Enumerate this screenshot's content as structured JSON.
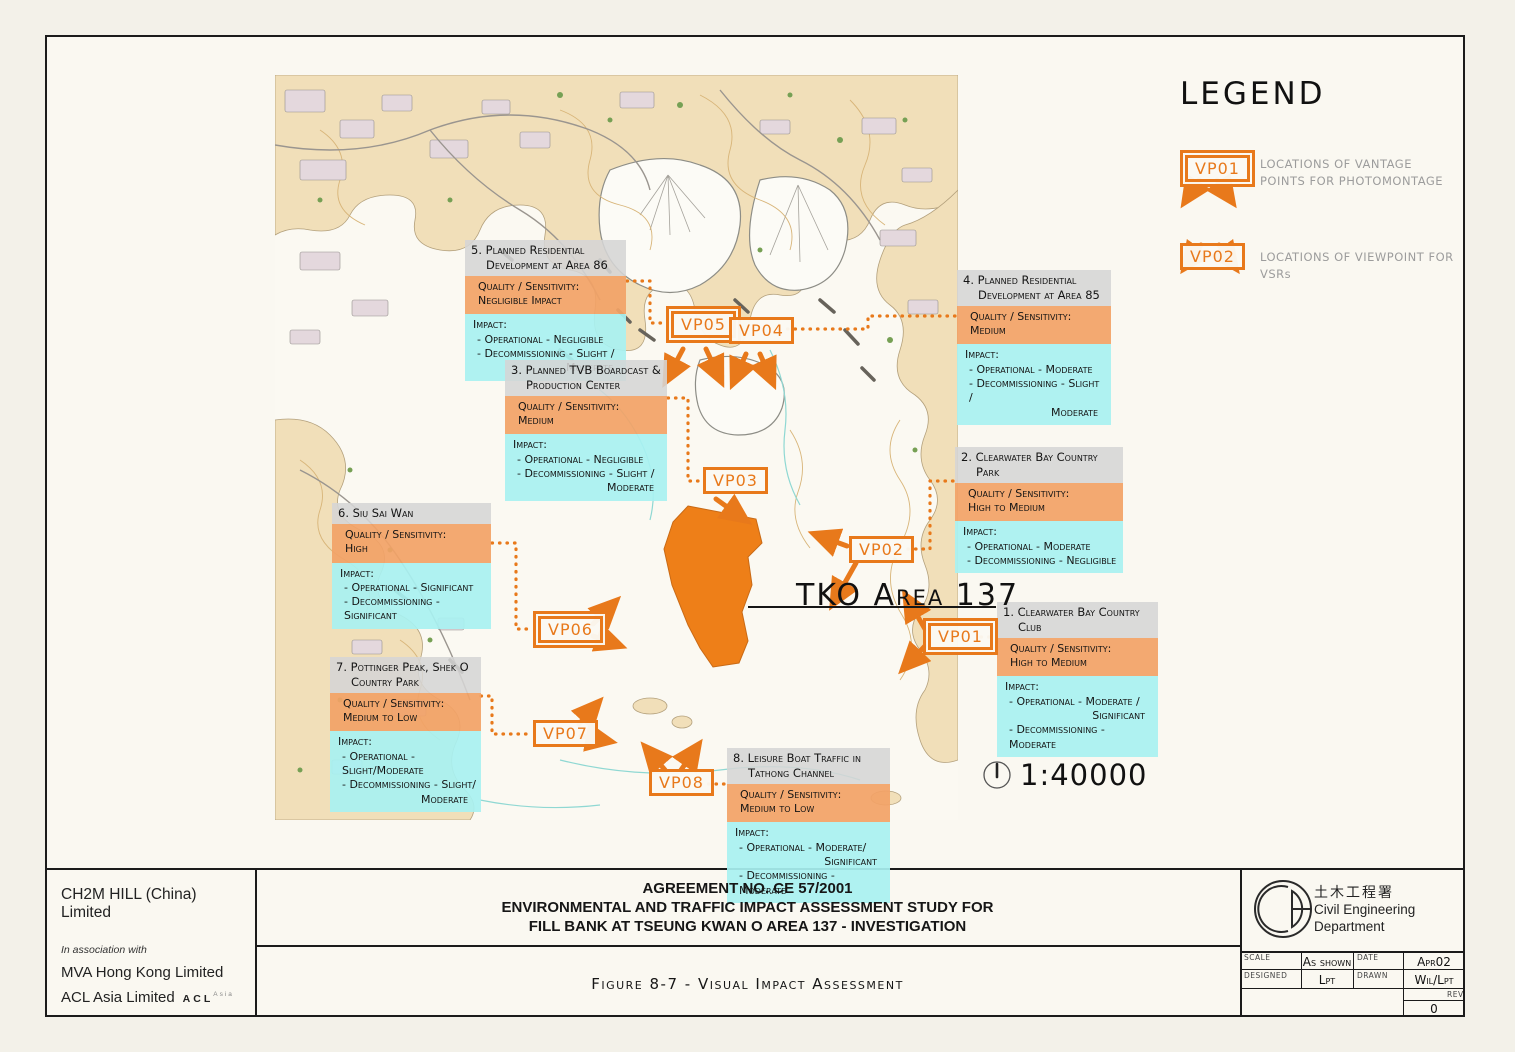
{
  "legend": {
    "title": "LEGEND",
    "items": [
      {
        "marker": "VP01",
        "label": "LOCATIONS OF VANTAGE POINTS FOR PHOTOMONTAGE"
      },
      {
        "marker": "VP02",
        "label": "LOCATIONS OF VIEWPOINT FOR VSRs"
      }
    ]
  },
  "map": {
    "area_label": "TKO Area 137",
    "scale_text": "1:40000",
    "markers": [
      {
        "label": "VP01"
      },
      {
        "label": "VP02"
      },
      {
        "label": "VP03"
      },
      {
        "label": "VP04"
      },
      {
        "label": "VP05"
      },
      {
        "label": "VP06"
      },
      {
        "label": "VP07"
      },
      {
        "label": "VP08"
      }
    ]
  },
  "callouts": [
    {
      "title": "1. Clearwater Bay Country Club",
      "quality_label": "Quality / Sensitivity:",
      "quality_value": "High to Medium",
      "impact_label": "Impact:",
      "impact_lines": [
        "- Operational - Moderate /",
        "Significant",
        "- Decommissioning - Moderate"
      ]
    },
    {
      "title": "2. Clearwater Bay Country Park",
      "quality_label": "Quality / Sensitivity:",
      "quality_value": "High to Medium",
      "impact_label": "Impact:",
      "impact_lines": [
        "- Operational - Moderate",
        "- Decommissioning - Negligible"
      ]
    },
    {
      "title": "3. Planned TVB Boardcast & Production Center",
      "quality_label": "Quality / Sensitivity:",
      "quality_value": "Medium",
      "impact_label": "Impact:",
      "impact_lines": [
        "- Operational - Negligible",
        "- Decommissioning - Slight /",
        "Moderate"
      ]
    },
    {
      "title": "4. Planned Residential Development at Area 85",
      "quality_label": "Quality / Sensitivity:",
      "quality_value": "Medium",
      "impact_label": "Impact:",
      "impact_lines": [
        "- Operational - Moderate",
        "- Decommissioning - Slight /",
        "Moderate"
      ]
    },
    {
      "title": "5. Planned Residential Development at Area 86",
      "quality_label": "Quality / Sensitivity:",
      "quality_value": "Negligible Impact",
      "impact_label": "Impact:",
      "impact_lines": [
        "- Operational - Negligible",
        "- Decommissioning - Slight /",
        "Moderate"
      ]
    },
    {
      "title": "6. Siu Sai Wan",
      "quality_label": "Quality / Sensitivity:",
      "quality_value": "High",
      "impact_label": "Impact:",
      "impact_lines": [
        "- Operational - Significant",
        "- Decommissioning - Significant"
      ]
    },
    {
      "title": "7. Pottinger Peak, Shek O Country Park",
      "quality_label": "Quality / Sensitivity:",
      "quality_value": "Medium to Low",
      "impact_label": "Impact:",
      "impact_lines": [
        "- Operational - Slight/Moderate",
        "- Decommissioning - Slight/",
        "Moderate"
      ]
    },
    {
      "title": "8. Leisure Boat Traffic in Tathong Channel",
      "quality_label": "Quality / Sensitivity:",
      "quality_value": "Medium to Low",
      "impact_label": "Impact:",
      "impact_lines": [
        "- Operational - Moderate/",
        "Significant",
        "- Decommissioning - Moderate"
      ]
    }
  ],
  "title_block": {
    "consultant": {
      "name": "CH2M HILL (China) Limited",
      "association": "In association with",
      "partner1": "MVA Hong Kong Limited",
      "partner2": "ACL Asia Limited",
      "acl_logo": "ACL",
      "acl_logo_sub": "Asia"
    },
    "agreement": {
      "line1": "AGREEMENT NO. CE 57/2001",
      "line2": "ENVIRONMENTAL AND TRAFFIC IMPACT ASSESSMENT STUDY FOR",
      "line3": "FILL BANK AT TSEUNG KWAN O AREA 137 - INVESTIGATION"
    },
    "figure": "Figure 8-7 - Visual Impact Assessment",
    "department": {
      "chinese": "土木工程署",
      "english1": "Civil Engineering",
      "english2": "Department"
    },
    "fields": {
      "scale_label": "SCALE",
      "scale_value": "As shown",
      "date_label": "DATE",
      "date_value": "Apr02",
      "designed_label": "DESIGNED",
      "designed_value": "Lpt",
      "drawn_label": "DRAWN",
      "drawn_value": "Wil/Lpt",
      "rev_label": "REV",
      "rev_value": "0"
    }
  },
  "colors": {
    "accent_orange": "#E8791B",
    "area_fill_orange": "#EE7F18",
    "callout_header_gray": "#D5D5D5",
    "quality_band": "#F2A266",
    "impact_band": "#A8F1F1",
    "legend_text_gray": "#9C9C9C"
  }
}
